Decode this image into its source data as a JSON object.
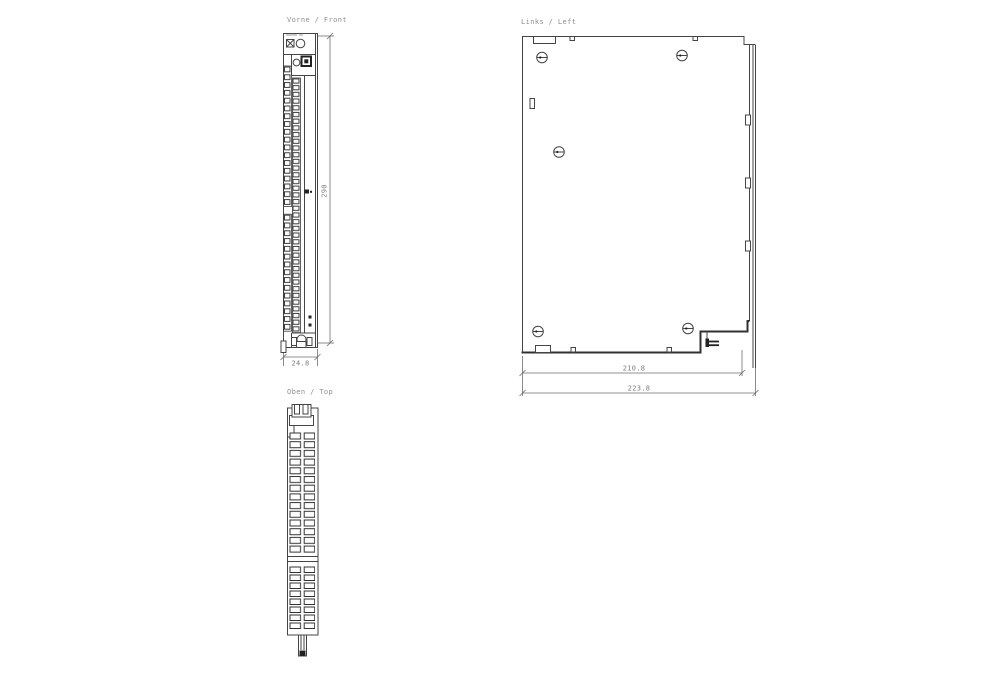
{
  "drawing": {
    "kind": "technical dimension drawing, three orthographic views of an electronics module",
    "colors": {
      "background": "#ffffff",
      "line": "#454545",
      "label_text": "#8f8f8f",
      "dim_text": "#7d7d7d",
      "dark_fill": "#222222"
    }
  },
  "views": {
    "front": {
      "label": "Vorne / Front",
      "dim_height": "290",
      "dim_width": "24.8"
    },
    "left": {
      "label": "Links / Left",
      "dim_inner": "210.8",
      "dim_outer": "223.8"
    },
    "top": {
      "label": "Oben / Top"
    }
  }
}
